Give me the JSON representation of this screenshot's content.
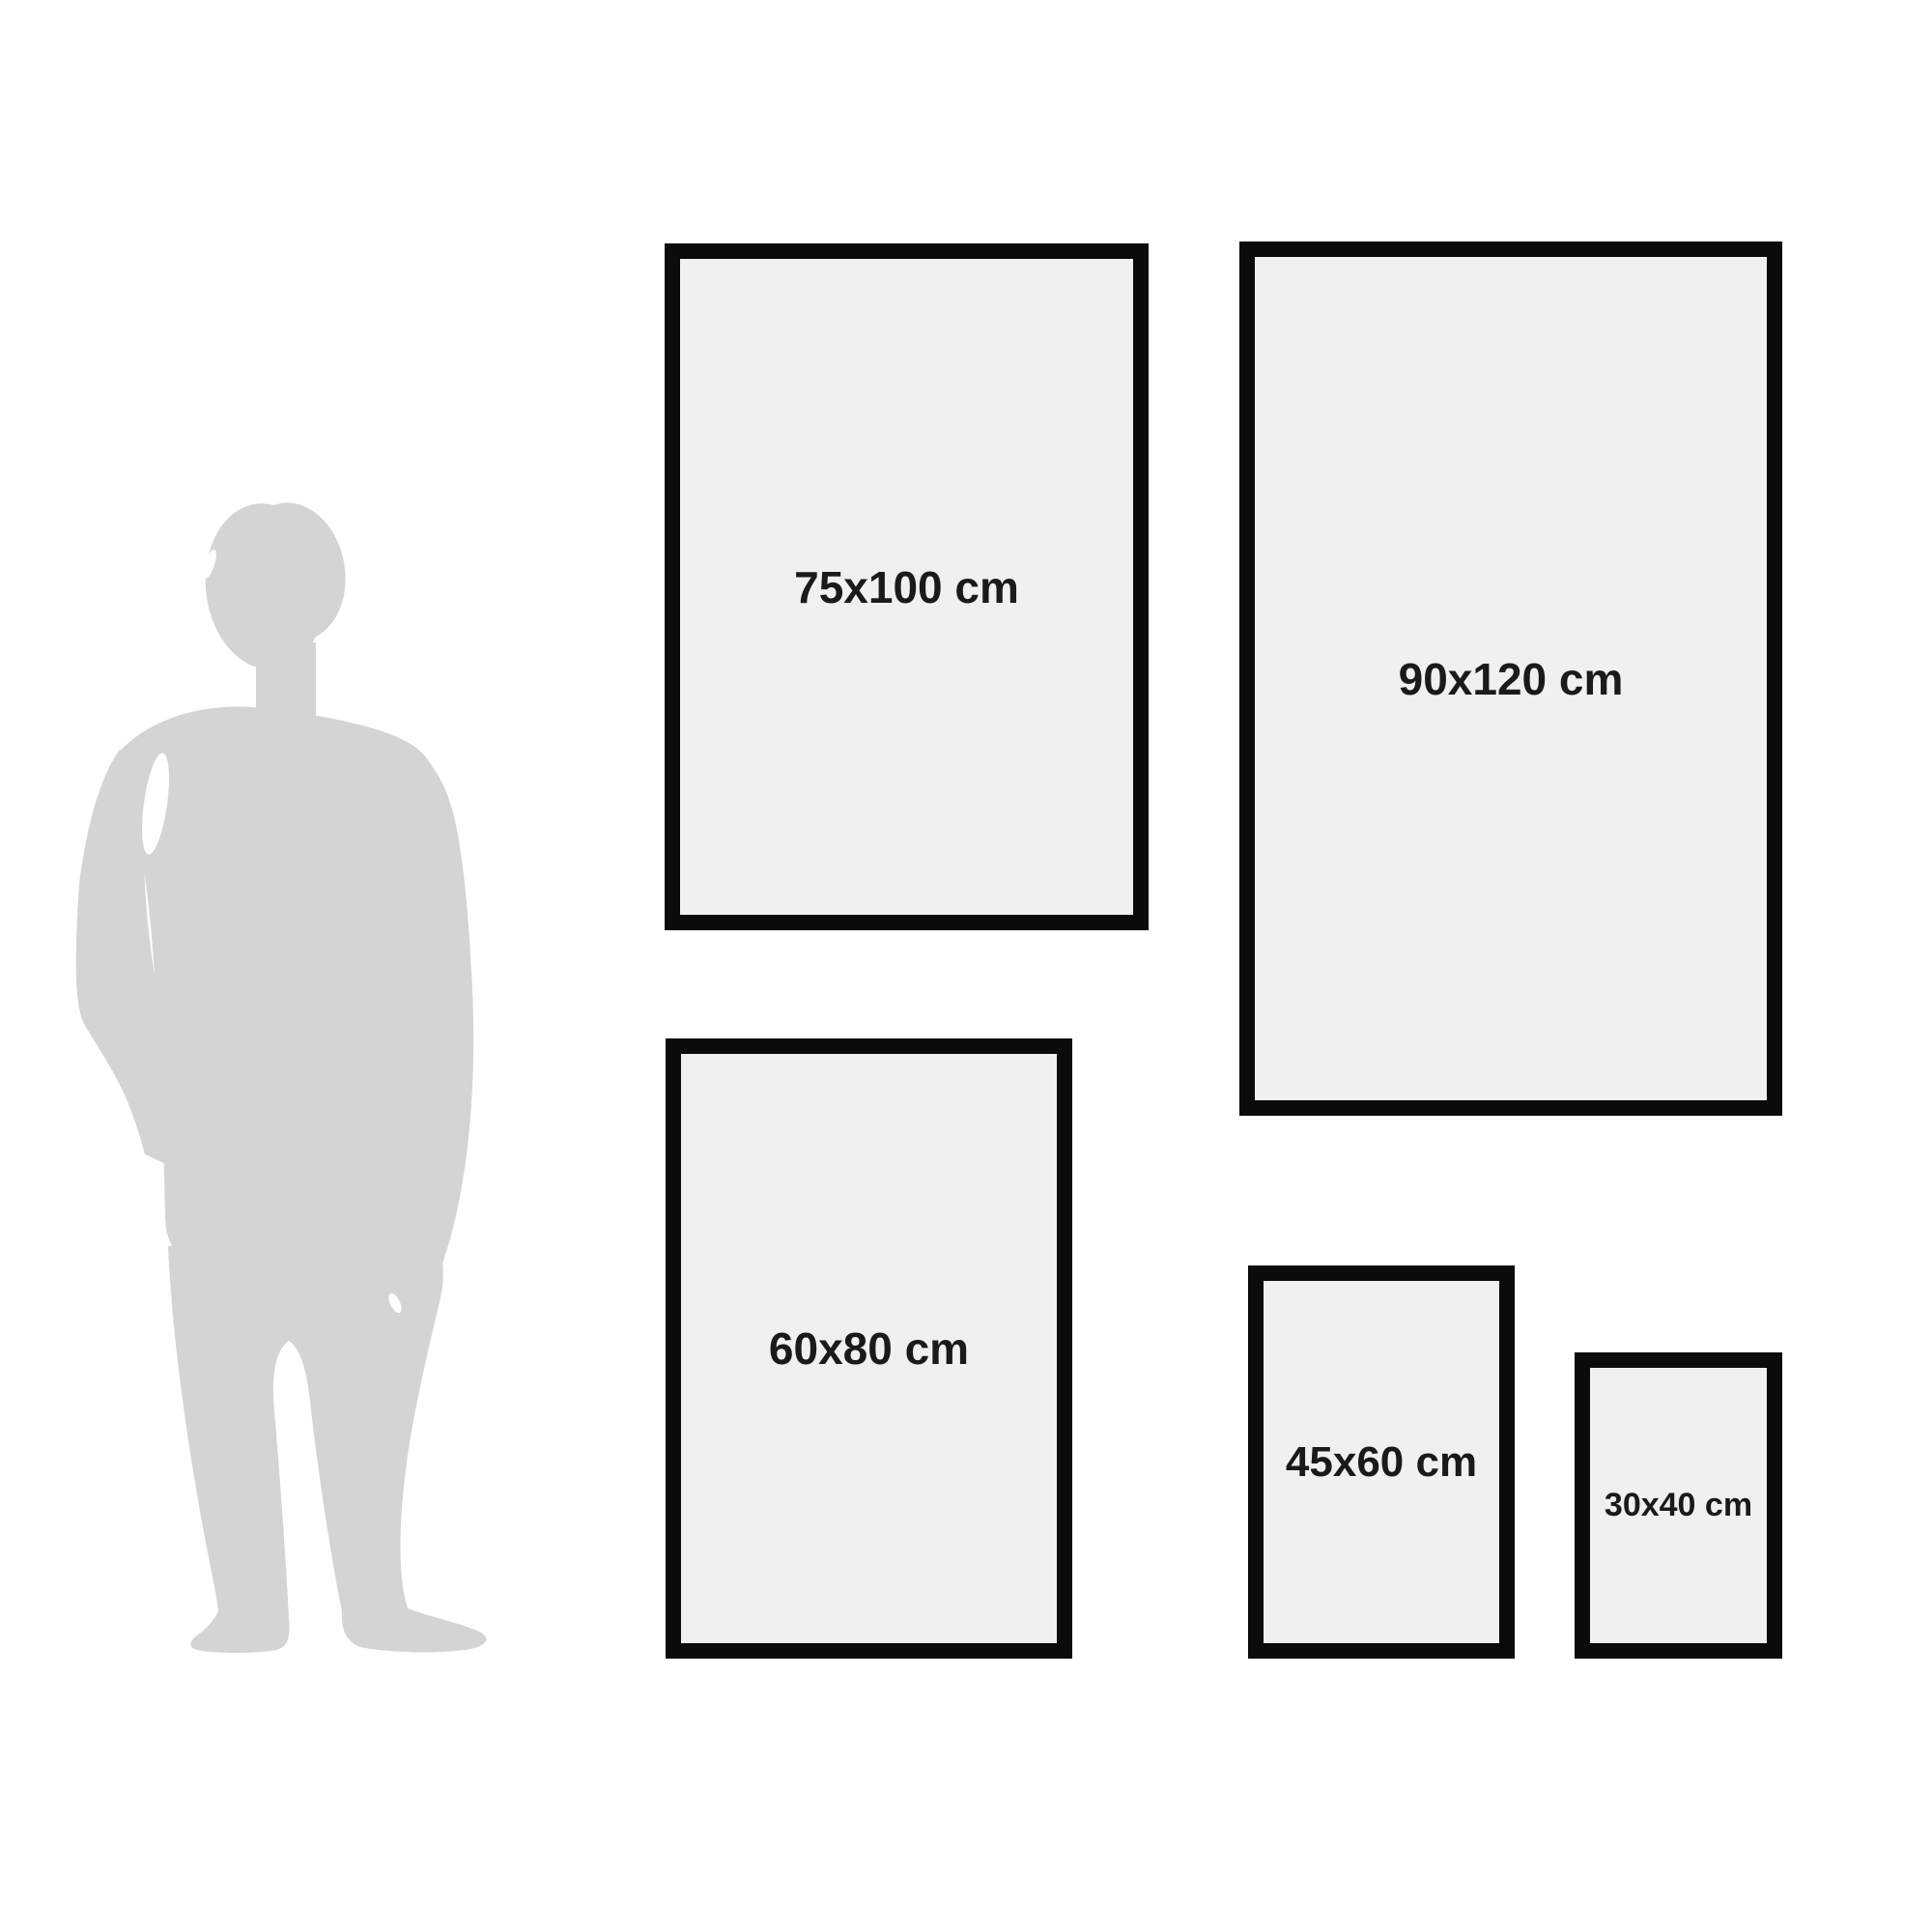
{
  "colors": {
    "background": "#ffffff",
    "frame_border": "#0b0b0b",
    "frame_fill": "#f0f0f1",
    "label_text": "#1a1a1a",
    "silhouette": "#d3d4d6"
  },
  "icons": {
    "person": "person-silhouette"
  },
  "frames": [
    {
      "id": "frame-75x100",
      "label": "75x100 cm"
    },
    {
      "id": "frame-90x120",
      "label": "90x120 cm"
    },
    {
      "id": "frame-60x80",
      "label": "60x80 cm"
    },
    {
      "id": "frame-45x60",
      "label": "45x60 cm"
    },
    {
      "id": "frame-30x40",
      "label": "30x40 cm"
    }
  ]
}
